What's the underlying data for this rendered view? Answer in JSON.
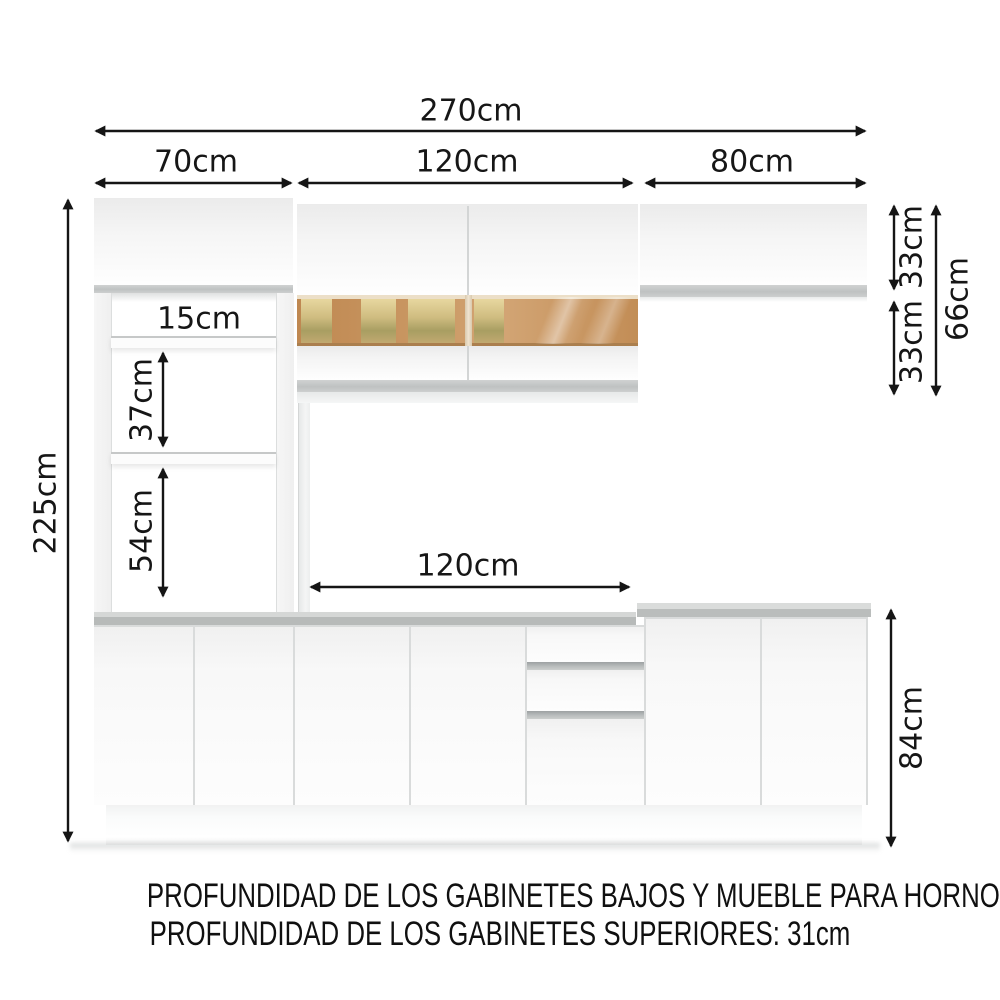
{
  "diagram": {
    "labels": {
      "total_width": "270cm",
      "left_section_width": "70cm",
      "middle_section_width": "120cm",
      "right_section_width": "80cm",
      "total_height": "225cm",
      "niche_gap": "15cm",
      "upper_shelf_gap": "37cm",
      "lower_shelf_gap": "54cm",
      "countertop_span": "120cm",
      "right_upper_cabinet_height": "33cm",
      "middle_upper_cabinet_lower_half": "33cm",
      "middle_upper_cabinet_total_height": "66cm",
      "base_cabinet_height": "84cm"
    },
    "footnotes": {
      "line1": "PROFUNDIDAD DE LOS GABINETES BAJOS Y MUEBLE PARA HORNO: 52cm",
      "line2": "PROFUNDIDAD DE LOS GABINETES SUPERIORES: 31cm"
    },
    "colors": {
      "dimension_line": "#151515",
      "counter_gray": "#b9bcbb",
      "glass_amber": "#cb9a66",
      "cabinet_white": "#fdfdfd"
    }
  }
}
